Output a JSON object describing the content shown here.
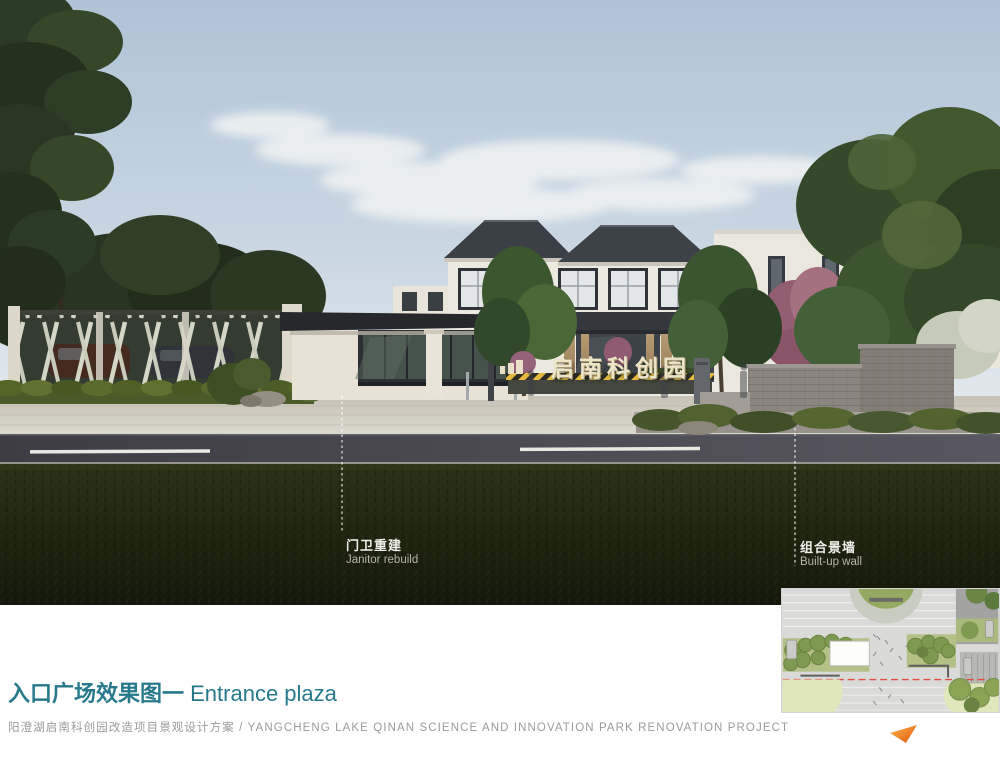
{
  "page": {
    "title_zh": "入口广场效果图一",
    "title_en": " Entrance plaza",
    "subtitle": "阳澄湖启南科创园改造项目景观设计方案 / YANGCHENG LAKE QINAN SCIENCE AND INNOVATION PARK RENOVATION PROJECT"
  },
  "rendering": {
    "gate_sign": "启南科创园",
    "annotations": [
      {
        "zh": "门卫重建",
        "en": "Janitor rebuild"
      },
      {
        "zh": "组合景墙",
        "en": "Built-up wall"
      }
    ]
  },
  "colors": {
    "title_teal": "#27798c",
    "subtitle_gray": "#9b9b9b",
    "arrow_orange": "#ee7622",
    "annotation_white": "#f0f0ea"
  }
}
